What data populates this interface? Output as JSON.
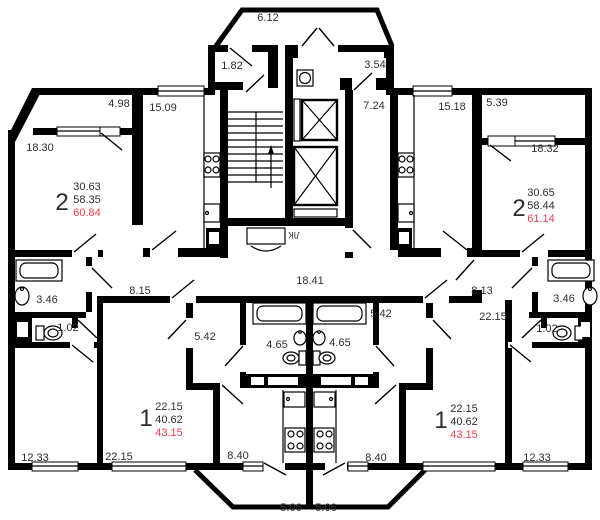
{
  "title": "Типовой этаж — план секции",
  "colors": {
    "wall": "#000000",
    "text": "#2e2e2e",
    "highlight_red": "#e8414e"
  },
  "common": {
    "porch": "6.12",
    "tambour": "1.82",
    "lobby": "3.54",
    "corridor_right": "7.24",
    "corridor": "18.41",
    "stairwell": "ЛК"
  },
  "apt_left_2r": {
    "num": "2",
    "living": "30.63",
    "total": "58.35",
    "total_balcony": "60.84",
    "room1": "18.30",
    "room2": "12.33",
    "kitchen": "15.09",
    "hall": "8.15",
    "bath": "3.46",
    "wc": "1.02",
    "balcony": "4.98"
  },
  "apt_right_2r": {
    "num": "2",
    "living": "30.65",
    "total": "58.44",
    "total_balcony": "61.14",
    "room1": "18.32",
    "room2": "12.33",
    "kitchen": "15.18",
    "hall": "8.13",
    "bath": "3.46",
    "wc": "1.02",
    "balcony": "5.39"
  },
  "apt_left_1r": {
    "num": "1",
    "living": "22.15",
    "total": "40.62",
    "total_balcony": "43.15",
    "room": "22.15",
    "kitchen": "8.40",
    "hall": "5.42",
    "bath": "4.65",
    "balcony": "5.06"
  },
  "apt_right_1r": {
    "num": "1",
    "living": "22.15",
    "total": "40.62",
    "total_balcony": "43.15",
    "room": "22.15",
    "kitchen": "8.40",
    "hall": "5.42",
    "bath": "4.65",
    "balcony": "5.06"
  }
}
